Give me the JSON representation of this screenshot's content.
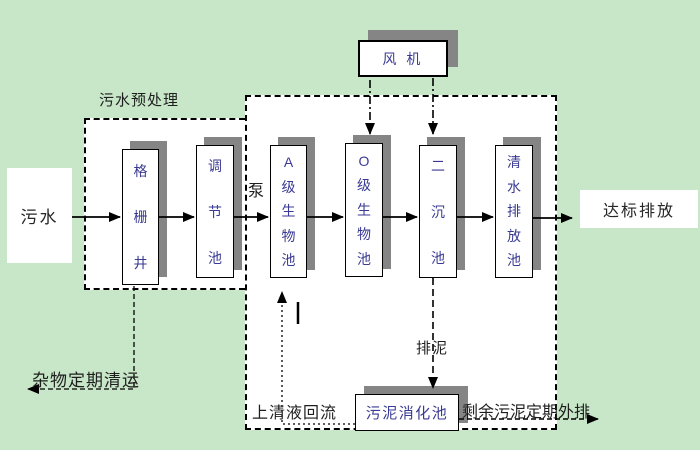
{
  "diagram": {
    "title": "污水处理工艺流程图",
    "type": "wastewater-treatment-process-flow"
  },
  "labels": {
    "pretreatment_title": "污水预处理",
    "pump": "泵",
    "debris_removal": "杂物定期清运",
    "supernatant_return": "上清液回流",
    "sludge_discharge": "排泥",
    "excess_sludge": "剩余污泥定期外排"
  },
  "nodes": {
    "source": {
      "label": "污水"
    },
    "fan": {
      "label": "风 机"
    },
    "grid_well": {
      "label": "格\n栅\n井"
    },
    "regulating_tank": {
      "label": "调\n节\n池"
    },
    "a_bio_tank": {
      "label": "A\n级\n生\n物\n池"
    },
    "o_bio_tank": {
      "label": "O\n级\n生\n物\n池"
    },
    "secondary_sed_tank": {
      "label": "二\n沉\n池"
    },
    "clean_water_tank": {
      "label": "清\n水\n排\n放\n池"
    },
    "sludge_digestion_tank": {
      "label": "污泥消化池"
    },
    "discharge": {
      "label": "达标排放"
    }
  },
  "colors": {
    "background": "#c8e6c8",
    "box_fill": "#ffffff",
    "box_border": "#000000",
    "box_shadow": "#858585",
    "box_text": "#3a3a94",
    "label_text": "#1e1e1e",
    "line": "#000000"
  }
}
